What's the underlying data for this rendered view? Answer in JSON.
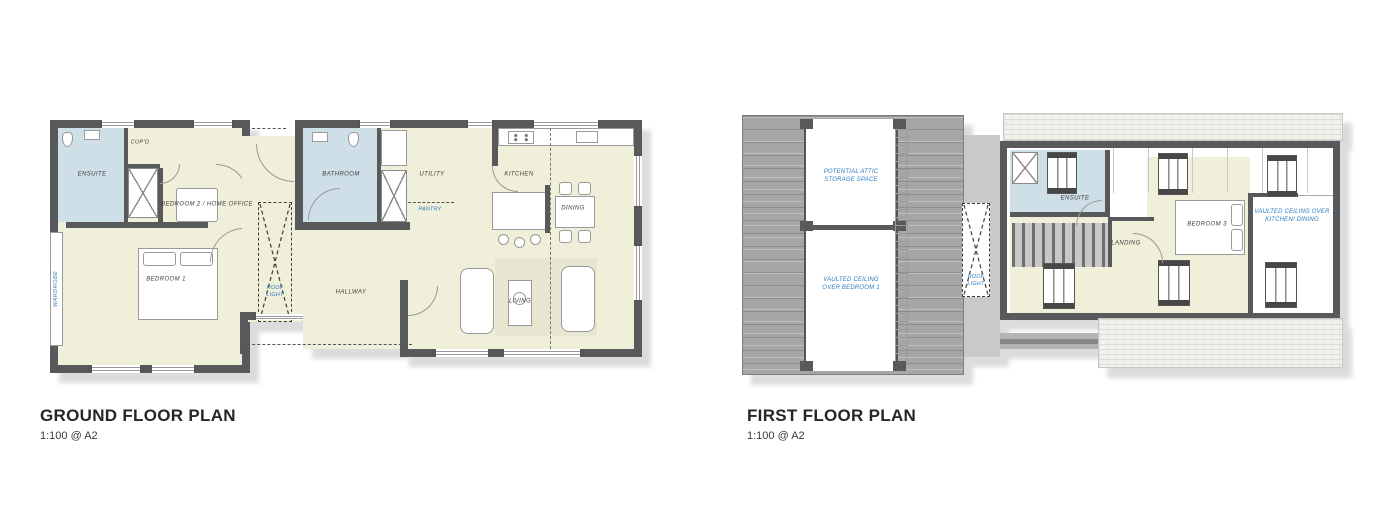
{
  "document": {
    "type": "architectural floor plan drawing"
  },
  "colors": {
    "wall": "#58595b",
    "floor": "#f0efda",
    "wet": "#cfdfe8",
    "roof": "#a6a6a6",
    "hatch": "#f2f1ec",
    "shadow": "#dcdcdc",
    "blue": "#2e7cc0",
    "label": "#3d3d3d"
  },
  "ground_floor": {
    "title": "GROUND FLOOR PLAN",
    "scale": "1:100 @ A2",
    "labels": {
      "ensuite": "ENSUITE",
      "cupd": "CUP'D",
      "bedroom2": "BEDROOM 2 / HOME OFFICE",
      "bedroom1": "BEDROOM 1",
      "wardrobe": "WARDROBE",
      "roof_light": "ROOF LIGHT",
      "hallway": "HALLWAY",
      "bathroom": "BATHROOM",
      "utility": "UTILITY",
      "pantry": "PANTRY",
      "kitchen": "KITCHEN",
      "dining": "DINING",
      "living": "LIVING"
    }
  },
  "first_floor": {
    "title": "FIRST FLOOR PLAN",
    "scale": "1:100 @ A2",
    "labels": {
      "attic": "POTENTIAL ATTIC STORAGE SPACE",
      "vaulted_bedroom": "VAULTED CEILING OVER  BEDROOM 1",
      "roof_light": "ROOF LIGHT",
      "ensuite": "ENSUITE",
      "landing": "LANDING",
      "bedroom3": "BEDROOM 3",
      "vaulted_kitchen": "VAULTED CEILING OVER KITCHEN/ DINING"
    }
  }
}
